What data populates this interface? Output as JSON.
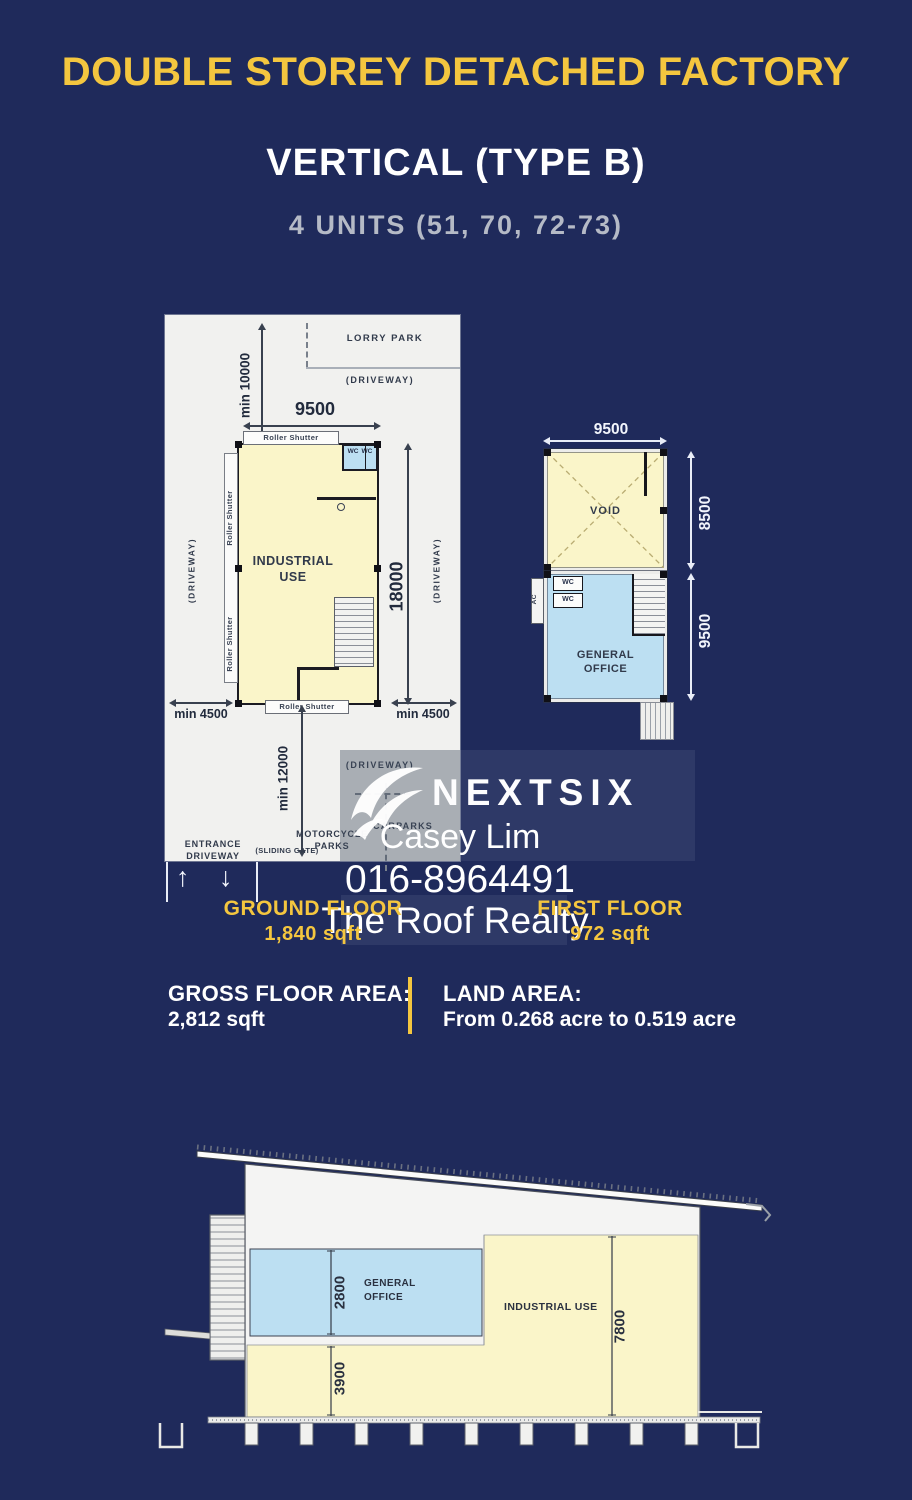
{
  "header": {
    "title": "DOUBLE STOREY DETACHED FACTORY",
    "subtitle": "VERTICAL (TYPE B)",
    "units": "4 UNITS (51, 70, 72-73)"
  },
  "ground_plan": {
    "lorry_park": "LORRY PARK",
    "driveway_top": "(DRIVEWAY)",
    "driveway_left": "(DRIVEWAY)",
    "driveway_right": "(DRIVEWAY)",
    "driveway_lower": "(DRIVEWAY)",
    "dim_min_10000": "min 10000",
    "dim_9500": "9500",
    "dim_18000": "18000",
    "dim_min_4500_left": "min 4500",
    "dim_min_4500_right": "min 4500",
    "dim_min_12000": "min 12000",
    "roller_shutter_top": "Roller Shutter",
    "roller_shutter_left_upper": "Roller Shutter",
    "roller_shutter_left_lower": "Roller Shutter",
    "roller_shutter_bottom": "Roller Shutter",
    "wc1": "WC",
    "wc2": "WC",
    "industrial_use": "INDUSTRIAL USE",
    "carparks": "CARPARKS",
    "motorcycle_parks": "MOTORCYCLE\nPARKS",
    "entrance_driveway": "ENTRANCE\nDRIVEWAY",
    "sliding_gate": "(SLIDING GATE)",
    "arrow_up": "↑",
    "arrow_down": "↓"
  },
  "first_floor_plan": {
    "dim_9500_top": "9500",
    "dim_8500": "8500",
    "dim_9500_right": "9500",
    "void": "VOID",
    "ac": "AC",
    "wc1": "WC",
    "wc2": "WC",
    "general_office": "GENERAL\nOFFICE"
  },
  "watermark": {
    "brand": "NEXTSIX",
    "agent": "Casey Lim",
    "phone": "016-8964491",
    "agency": "The Roof Realty"
  },
  "floors": {
    "ground_label": "GROUND FLOOR",
    "ground_area": "1,840 sqft",
    "first_label": "FIRST FLOOR",
    "first_area": "972 sqft"
  },
  "summary": {
    "gfa_label": "GROSS FLOOR AREA:",
    "gfa_value": "2,812 sqft",
    "land_label": "LAND AREA:",
    "land_value": "From 0.268 acre to 0.519 acre"
  },
  "section": {
    "dim_2800": "2800",
    "dim_3900": "3900",
    "dim_7800": "7800",
    "general_office": "GENERAL\nOFFICE",
    "industrial_use": "INDUSTRIAL USE"
  },
  "colors": {
    "background_navy": "#1F2A5B",
    "accent_yellow": "#F4C63F",
    "plan_yellow": "#FAF5C9",
    "plan_blue": "#BCDFF2",
    "plan_white": "#F1F1EF"
  }
}
